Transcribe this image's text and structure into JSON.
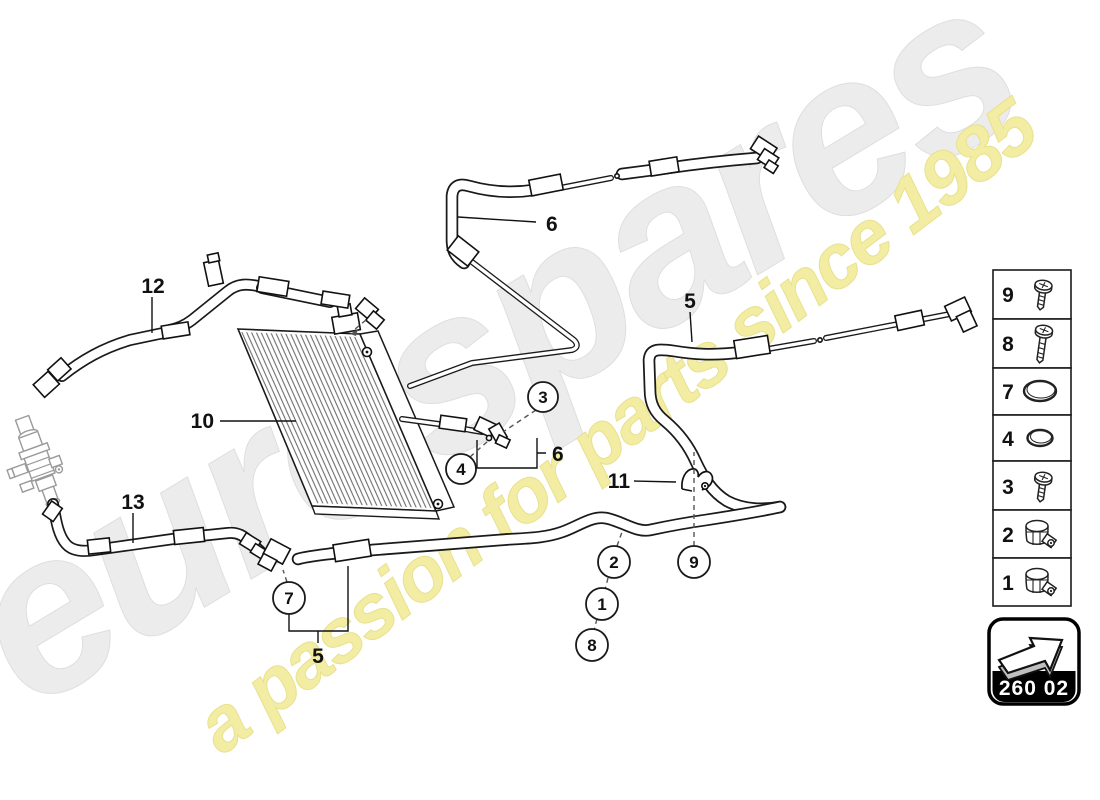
{
  "watermark": {
    "brand": "eurospares",
    "tagline": "a passion for parts since 1985",
    "brand_color": "#ececec",
    "tagline_color": "#f2eda2"
  },
  "labels": {
    "hose12": "12",
    "condenser10": "10",
    "hose13": "13",
    "hose6_top": "6",
    "hose6_mid": "6",
    "hose5_right": "5",
    "hose5_bottom": "5",
    "clip11": "11"
  },
  "callouts": {
    "c1": "1",
    "c2": "2",
    "c3": "3",
    "c4": "4",
    "c7": "7",
    "c8": "8",
    "c9": "9"
  },
  "legend": {
    "rows": [
      {
        "number": "9",
        "icon": "screw-short"
      },
      {
        "number": "8",
        "icon": "screw-long"
      },
      {
        "number": "7",
        "icon": "o-ring-large"
      },
      {
        "number": "4",
        "icon": "o-ring-small"
      },
      {
        "number": "3",
        "icon": "screw-short"
      },
      {
        "number": "2",
        "icon": "hose-clamp"
      },
      {
        "number": "1",
        "icon": "hose-clamp"
      }
    ]
  },
  "badge": {
    "code": "260 02"
  },
  "colors": {
    "line": "#1a1a1a",
    "context_gray": "#9a9a9a",
    "badge_bg": "#000000",
    "badge_text": "#ffffff"
  }
}
